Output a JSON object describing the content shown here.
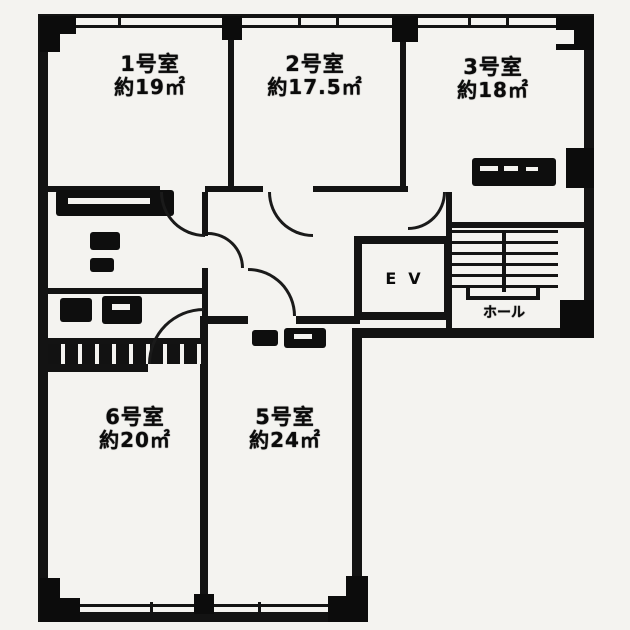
{
  "plan": {
    "type": "floor-plan",
    "rooms": [
      {
        "id": "1",
        "name": "1号室",
        "area": "約19㎡"
      },
      {
        "id": "2",
        "name": "2号室",
        "area": "約17.5㎡"
      },
      {
        "id": "3",
        "name": "3号室",
        "area": "約18㎡"
      },
      {
        "id": "6",
        "name": "6号室",
        "area": "約20㎡"
      },
      {
        "id": "5",
        "name": "5号室",
        "area": "約24㎡"
      }
    ],
    "elevator_label": "EV",
    "hall_label": "ホール",
    "colors": {
      "wall": "#131313",
      "paper": "#f4f3f0"
    }
  }
}
